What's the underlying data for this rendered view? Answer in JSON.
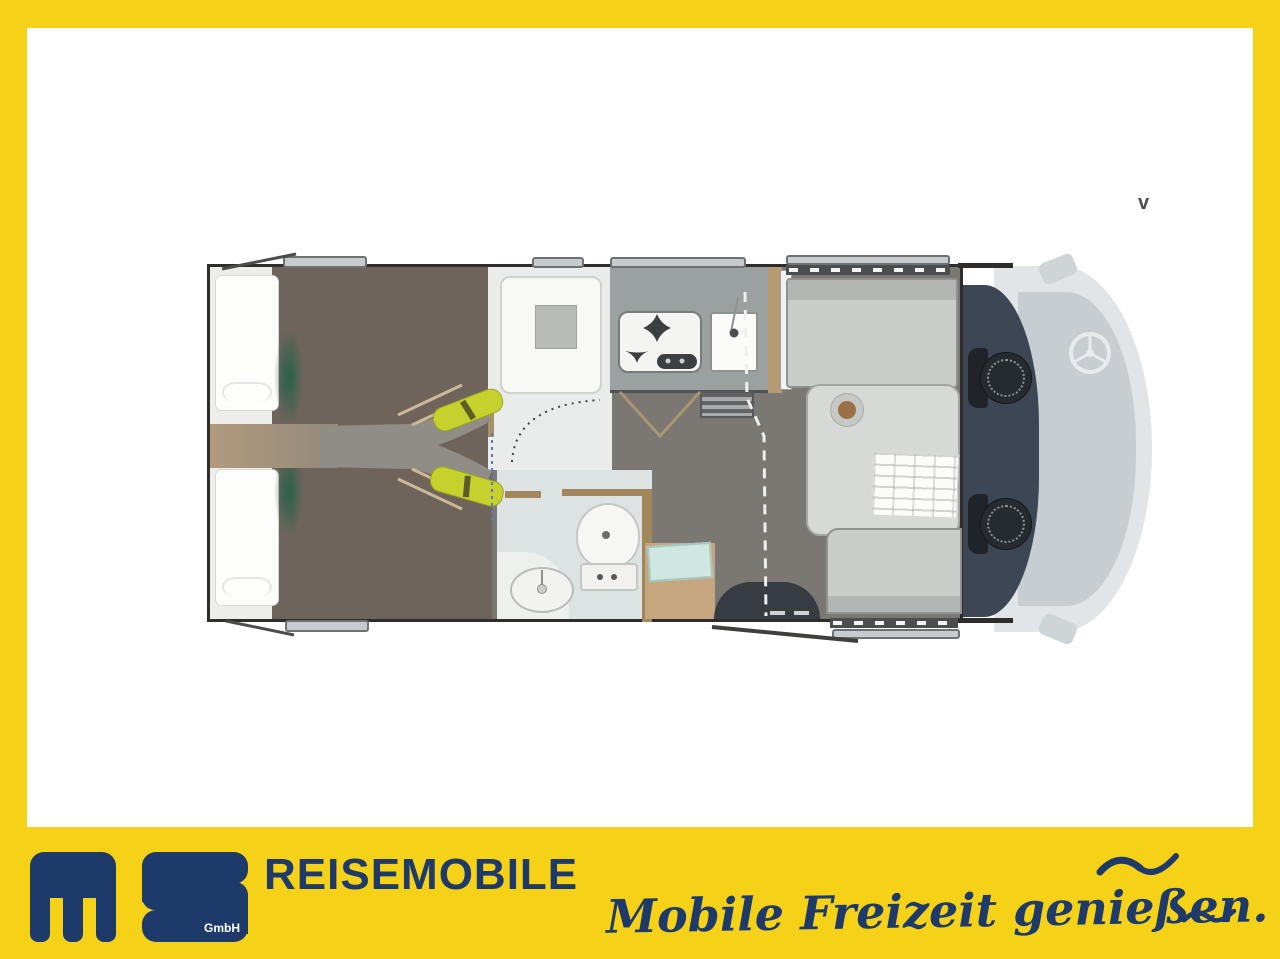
{
  "watermark": {
    "text": "v"
  },
  "banner": {
    "brand": "REISEMOBILE",
    "logo": {
      "name": "ms-logo",
      "gmbh": "GmbH"
    },
    "slogan": "Mobile Freizeit genießen.",
    "colors": {
      "yellow": "#F5D118",
      "navy": "#1D3A6B"
    }
  },
  "floorplan": {
    "type": "motorhome-top-view",
    "features": [
      "rear-single-bed-left",
      "rear-single-bed-right",
      "bed-steps-with-cushions",
      "shower-cabin",
      "toilet",
      "washbasin",
      "kitchen-stove-two-burners",
      "kitchen-sink",
      "wardrobe",
      "dinette-bench-front",
      "dinette-bench-side",
      "dinette-table",
      "entry-door-step",
      "cab-swivel-seat-driver",
      "cab-swivel-seat-passenger",
      "steering-wheel",
      "ghost-cab-outline",
      "windows"
    ],
    "colors": {
      "bed_platform": "#6F645B",
      "aisle_tan": "#B29A7D",
      "aisle_gray": "#908D87",
      "step_cushions": "#C7D12D",
      "green_accent": "#1A6148",
      "floor_gray": "#7B7874",
      "bath_floor": "#DDE2E3",
      "kitchen_counter": "#9BA1A1",
      "furniture_light": "#CBCDCA",
      "cab_floor": "#3D4654",
      "ghost_body": "#E1E5E7",
      "entry_floor": "#C5A67E",
      "entry_mat": "#CFE7E0",
      "outline": "#2E2D2B"
    }
  }
}
